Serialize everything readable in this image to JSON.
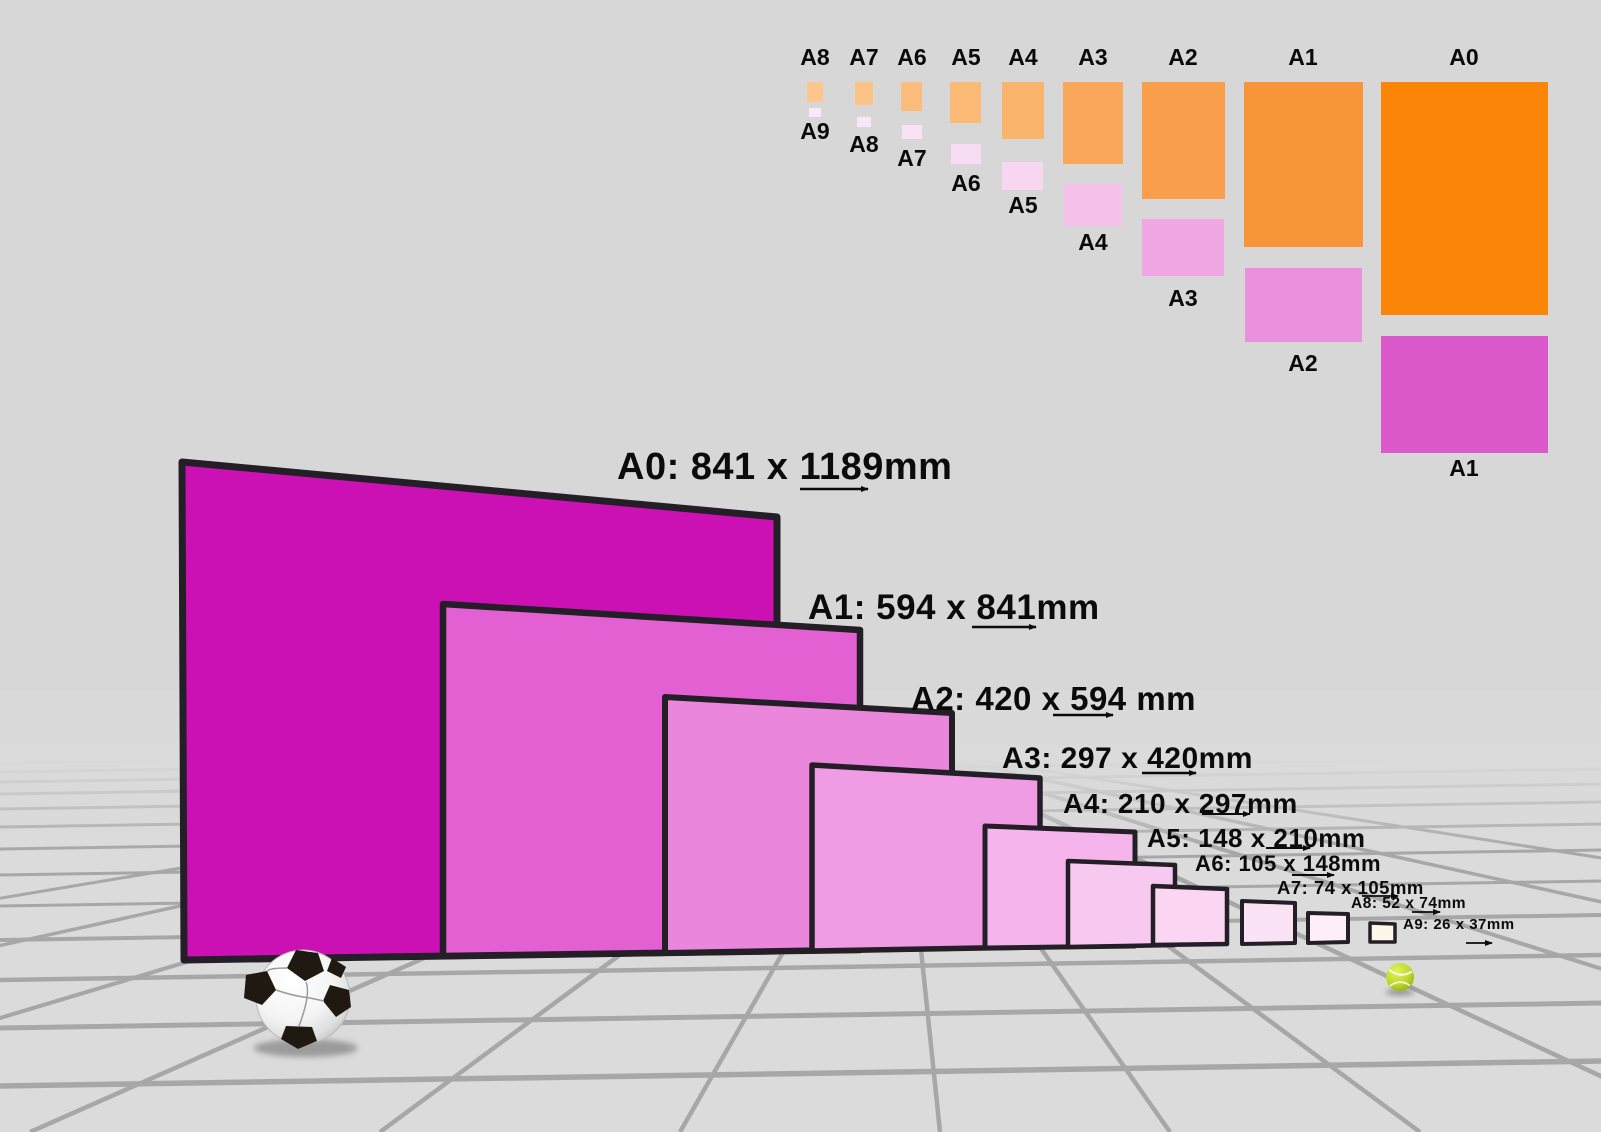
{
  "mini_chart": {
    "pairs": [
      {
        "parent_label": "A8",
        "child_label": "A9"
      },
      {
        "parent_label": "A7",
        "child_label": "A8"
      },
      {
        "parent_label": "A6",
        "child_label": "A7"
      },
      {
        "parent_label": "A5",
        "child_label": "A6"
      },
      {
        "parent_label": "A4",
        "child_label": "A5"
      },
      {
        "parent_label": "A3",
        "child_label": "A4"
      },
      {
        "parent_label": "A2",
        "child_label": "A3"
      },
      {
        "parent_label": "A1",
        "child_label": "A2"
      },
      {
        "parent_label": "A0",
        "child_label": "A1"
      }
    ],
    "orange_shades": [
      "#FCC68C",
      "#FCC286",
      "#FBBD7C",
      "#FBBA76",
      "#FBB46B",
      "#FAA65B",
      "#F99E4B",
      "#F99539",
      "#FB8506"
    ],
    "pink_shades": [
      "#FAEAF8",
      "#F9E6F6",
      "#F9E2F5",
      "#F8DCF3",
      "#F8D6F1",
      "#F6C2EC",
      "#F0A7E3",
      "#EA90DD",
      "#DC59CB"
    ]
  },
  "scene": {
    "labels": [
      {
        "size": "A0",
        "text": "A0: 841 x 1189mm",
        "width_mm": 841,
        "height_mm": 1189
      },
      {
        "size": "A1",
        "text": "A1: 594 x 841mm",
        "width_mm": 594,
        "height_mm": 841
      },
      {
        "size": "A2",
        "text": "A2: 420 x 594 mm",
        "width_mm": 420,
        "height_mm": 594
      },
      {
        "size": "A3",
        "text": "A3: 297 x 420mm",
        "width_mm": 297,
        "height_mm": 420
      },
      {
        "size": "A4",
        "text": "A4: 210 x 297mm",
        "width_mm": 210,
        "height_mm": 297
      },
      {
        "size": "A5",
        "text": "A5: 148 x 210mm",
        "width_mm": 148,
        "height_mm": 210
      },
      {
        "size": "A6",
        "text": "A6: 105 x 148mm",
        "width_mm": 105,
        "height_mm": 148
      },
      {
        "size": "A7",
        "text": "A7: 74 x 105mm",
        "width_mm": 74,
        "height_mm": 105
      },
      {
        "size": "A8",
        "text": "A8: 52 x 74mm",
        "width_mm": 52,
        "height_mm": 74
      },
      {
        "size": "A9",
        "text": "A9: 26 x 37mm",
        "width_mm": 26,
        "height_mm": 37
      }
    ],
    "sheet_fills": [
      "#CB11B4",
      "#E260D2",
      "#EB86DD",
      "#F09CE4",
      "#F5B5EC",
      "#F8C9F0",
      "#FAD6F3",
      "#FBE3F6",
      "#FDEEFA",
      "#FCF7E8"
    ],
    "sheet_border_color": "#241F27",
    "background_color": "#D8D8D8",
    "floor_line_color": "#A7A7A7",
    "scale_objects": [
      "soccer-ball",
      "tennis-ball"
    ],
    "tennis_ball_color": "#BCD82C"
  }
}
